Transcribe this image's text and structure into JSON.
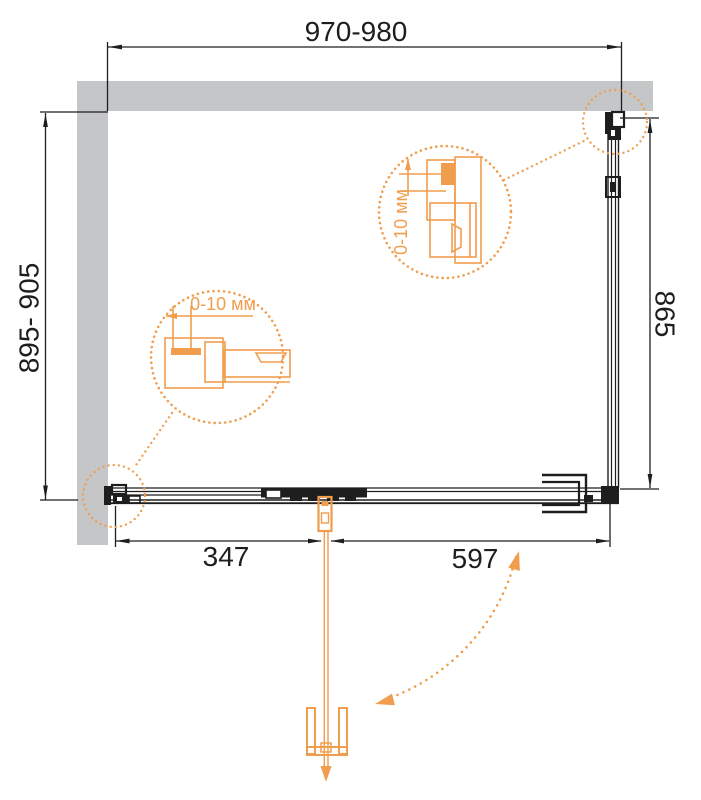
{
  "drawing": {
    "title": "shower-enclosure-plan-view",
    "dimensions": {
      "width_top": "970-980",
      "height_left": "895- 905",
      "height_right": "865",
      "bottom_fixed": "347",
      "bottom_door": "597"
    },
    "details": {
      "left_adjustment": "0-10 мм",
      "right_adjustment": "0-10 мм"
    },
    "colors": {
      "accent_orange": "#F09D4D",
      "wall_gray": "#C5C6C8",
      "line_black": "#1E1E1E"
    }
  }
}
